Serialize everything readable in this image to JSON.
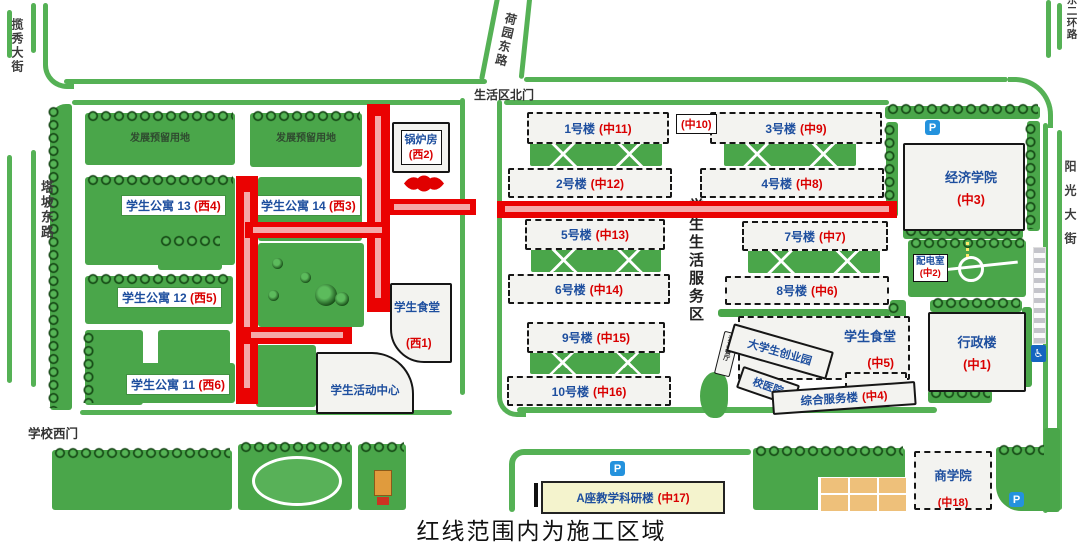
{
  "caption": "红线范围内为施工区域",
  "colors": {
    "construction_line": "#ea0202",
    "lane_stripe": "#f5a9a9",
    "lawn_green": "#4aa64a",
    "road_edge_green": "#55b155",
    "building_name_blue": "#1d4e9e",
    "building_code_red": "#d90000"
  },
  "roads": {
    "lanxiu_street": "揽秀大街",
    "tapo_east_road": "塔坡东路",
    "heyuan_east_road": "荷园东路",
    "east_2nd_ring_road": "东二环路",
    "yangguang_street": "阳光大街",
    "north_gate": "生活区北门",
    "west_gate": "学校西门"
  },
  "west": {
    "reserved_a": "发展预留用地",
    "reserved_b": "发展预留用地",
    "apartments": [
      {
        "name": "学生公寓 13",
        "code": "(西4)"
      },
      {
        "name": "学生公寓 14",
        "code": "(西3)"
      },
      {
        "name": "学生公寓 12",
        "code": "(西5)"
      },
      {
        "name": "学生公寓 11",
        "code": "(西6)"
      }
    ],
    "boiler": {
      "name": "锅炉房",
      "code": "(西2)"
    },
    "canteen": {
      "name": "学生食堂",
      "code": "(西1)"
    },
    "activity": {
      "name": "学生活动中心"
    }
  },
  "central": {
    "zone": "学生生活服务区",
    "code10": "(中10)",
    "dorms": [
      {
        "name": "1号楼",
        "code": "(中11)"
      },
      {
        "name": "3号楼",
        "code": "(中9)"
      },
      {
        "name": "2号楼",
        "code": "(中12)"
      },
      {
        "name": "4号楼",
        "code": "(中8)"
      },
      {
        "name": "5号楼",
        "code": "(中13)"
      },
      {
        "name": "7号楼",
        "code": "(中7)"
      },
      {
        "name": "6号楼",
        "code": "(中14)"
      },
      {
        "name": "8号楼",
        "code": "(中6)"
      },
      {
        "name": "9号楼",
        "code": "(中15)"
      },
      {
        "name": "10号楼",
        "code": "(中16)"
      }
    ],
    "canteen": {
      "name": "学生食堂",
      "code": "(中5)"
    },
    "startup_park": "大学生创业园",
    "halal_restaurant": "清真餐厅",
    "hospital": "校医院",
    "service_bldg": {
      "name": "综合服务楼",
      "code": "(中4)"
    }
  },
  "east": {
    "economics": {
      "name": "经济学院",
      "code": "(中3)"
    },
    "power_room": {
      "name": "配电室",
      "code": "(中2)"
    },
    "admin": {
      "name": "行政楼",
      "code": "(中1)"
    }
  },
  "south": {
    "research_a": {
      "name": "A座教学科研楼",
      "code": "(中17)"
    },
    "business": {
      "name": "商学院",
      "code": "(中18)"
    }
  },
  "icons": {
    "parking": "P",
    "accessible": "♿"
  }
}
